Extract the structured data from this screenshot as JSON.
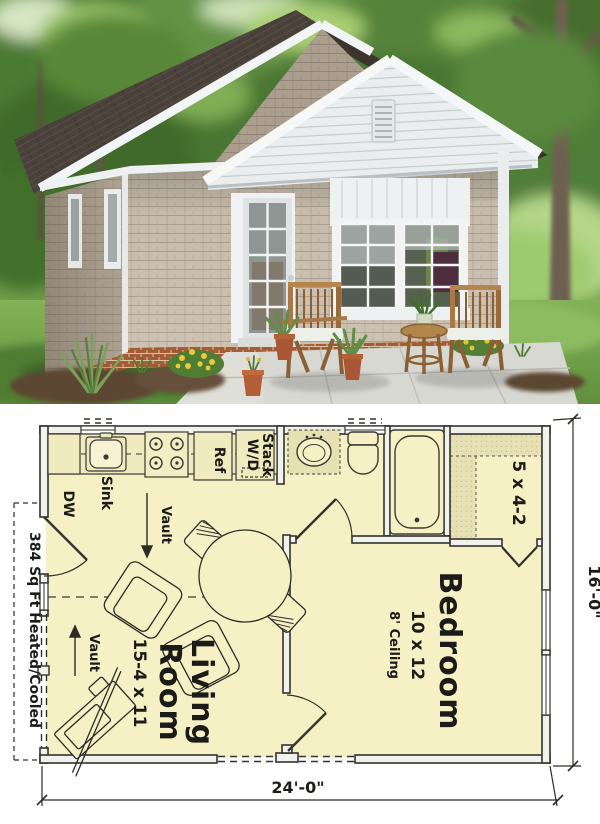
{
  "photo": {
    "description": "3D rendering of a small gray shingle-sided cottage with white trim, twin front gables, a glass French door, large gridded windows, two wooden patio chairs with a small round table and potted plants on a concrete patio, surrounded by trees and lawn"
  },
  "floor_plan": {
    "sq_ft_label": "384 Sq Ft Heated/Cooled",
    "width_dim": "24'-0\"",
    "height_dim": "16'-0\"",
    "vault_label": "Vault",
    "rooms": {
      "living": {
        "name_line1": "Living",
        "name_line2": "Room",
        "size": "15-4 x 11"
      },
      "bedroom": {
        "name": "Bedroom",
        "size": "10 x 12",
        "ceiling": "8' Ceiling"
      },
      "closet": {
        "size": "5 x 4-2"
      }
    },
    "kitchen": {
      "dw": "DW",
      "sink": "Sink",
      "ref": "Ref",
      "wd_line1": "Stack",
      "wd_line2": "W/D"
    },
    "colors": {
      "room_fill": "#f6f0c5",
      "shelf_fill": "#e7e0b2",
      "wall_fill": "#f2f2ed",
      "line": "#32322e"
    }
  }
}
